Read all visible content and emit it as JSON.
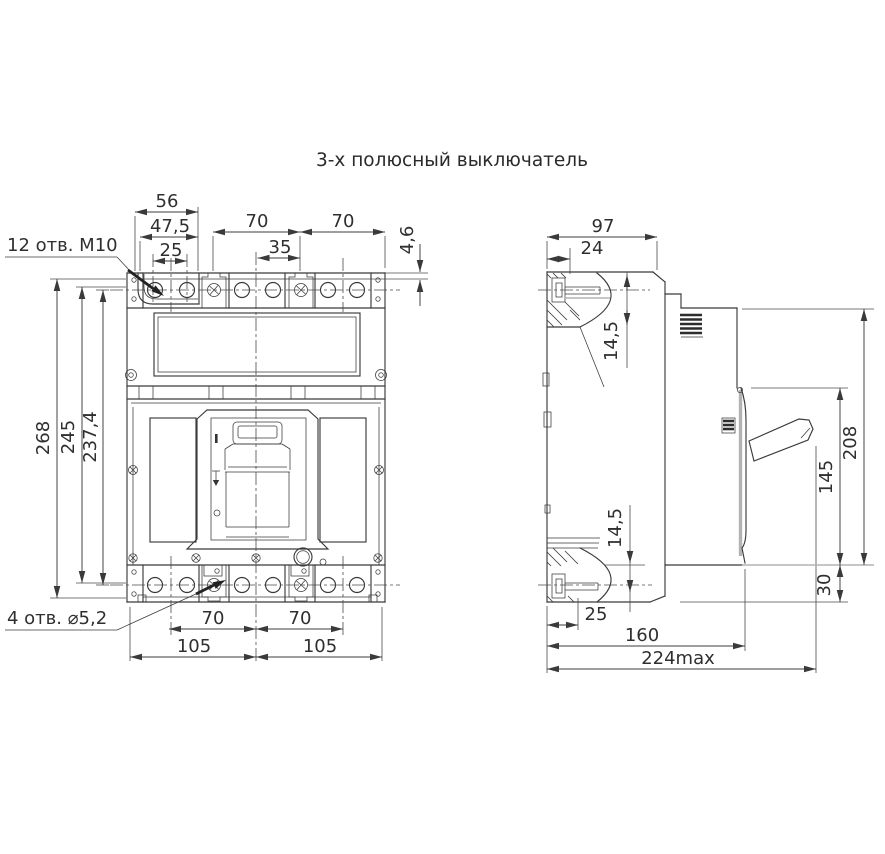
{
  "title": "3-х полюсный выключатель",
  "front": {
    "hole_label_top": "12 отв. М10",
    "hole_label_bottom": "4 отв. ⌀5,2",
    "dim_56": "56",
    "dim_47_5": "47,5",
    "dim_25": "25",
    "dim_70_top_left": "70",
    "dim_70_top_right": "70",
    "dim_35": "35",
    "dim_4_6": "4,6",
    "dim_268": "268",
    "dim_245": "245",
    "dim_237_4": "237,4",
    "dim_70_bottom_left": "70",
    "dim_70_bottom_right": "70",
    "dim_105_left": "105",
    "dim_105_right": "105"
  },
  "side": {
    "dim_97": "97",
    "dim_24": "24",
    "dim_14_5_top": "14,5",
    "dim_14_5_bottom": "14,5",
    "dim_25": "25",
    "dim_160": "160",
    "dim_224": "224max",
    "dim_208": "208",
    "dim_145": "145",
    "dim_30": "30"
  }
}
